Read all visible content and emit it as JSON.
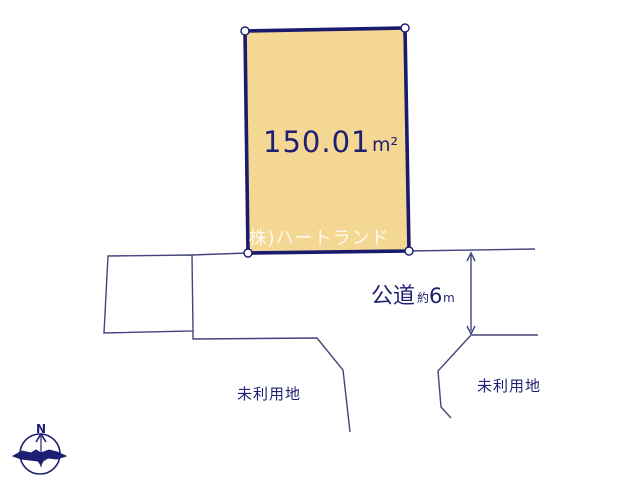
{
  "parcel": {
    "area_value": "150.01",
    "area_unit": "m²",
    "fill_color": "#f5d794",
    "border_color": "#1b1b6e"
  },
  "watermark": {
    "text": "(株)ハートランド"
  },
  "road": {
    "name": "公道",
    "approx_label": "約",
    "width_value": "6",
    "width_unit": "m"
  },
  "unused_land": {
    "left_label": "未利用地",
    "right_label": "未利用地"
  },
  "compass": {
    "north_label": "N"
  },
  "colors": {
    "line": "#43467e",
    "text": "#1e1e73",
    "background": "#ffffff"
  }
}
